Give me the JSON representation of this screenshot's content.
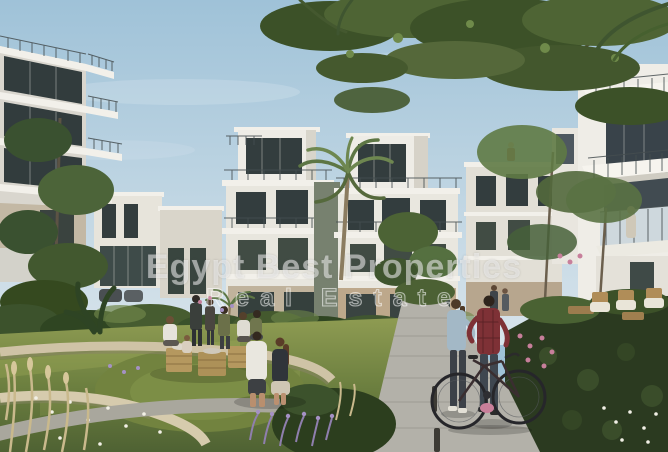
{
  "watermark": {
    "line1": "Egypt Best Properties",
    "line2": "Real Estate"
  },
  "palette": {
    "sky_top": "#9fc2d8",
    "sky_horizon": "#d8e4eb",
    "building_white": "#eceae3",
    "building_shade": "#cfccc2",
    "wall_beige": "#bda88b",
    "window_dark": "#333d3e",
    "glass_blue": "#c8d4da",
    "foliage_dark": "#33471f",
    "foliage_mid": "#4e6434",
    "foliage_light": "#6f8a4a",
    "hedge_dark": "#2b3a20",
    "lawn_light": "#93a055",
    "lawn_dark": "#4f6233",
    "path_gray": "#b3b1a9",
    "stone_wall": "#cfc3a6",
    "crate_tan": "#b5985f",
    "trunk_brown": "#8b7c60",
    "denim_blue": "#a3b8c6",
    "plaid_red": "#7e3136",
    "shirt_white": "#e9e7df",
    "flower_purple": "#8f7fae",
    "flower_pink": "#c77f9b",
    "flower_white": "#f2f0e6"
  }
}
